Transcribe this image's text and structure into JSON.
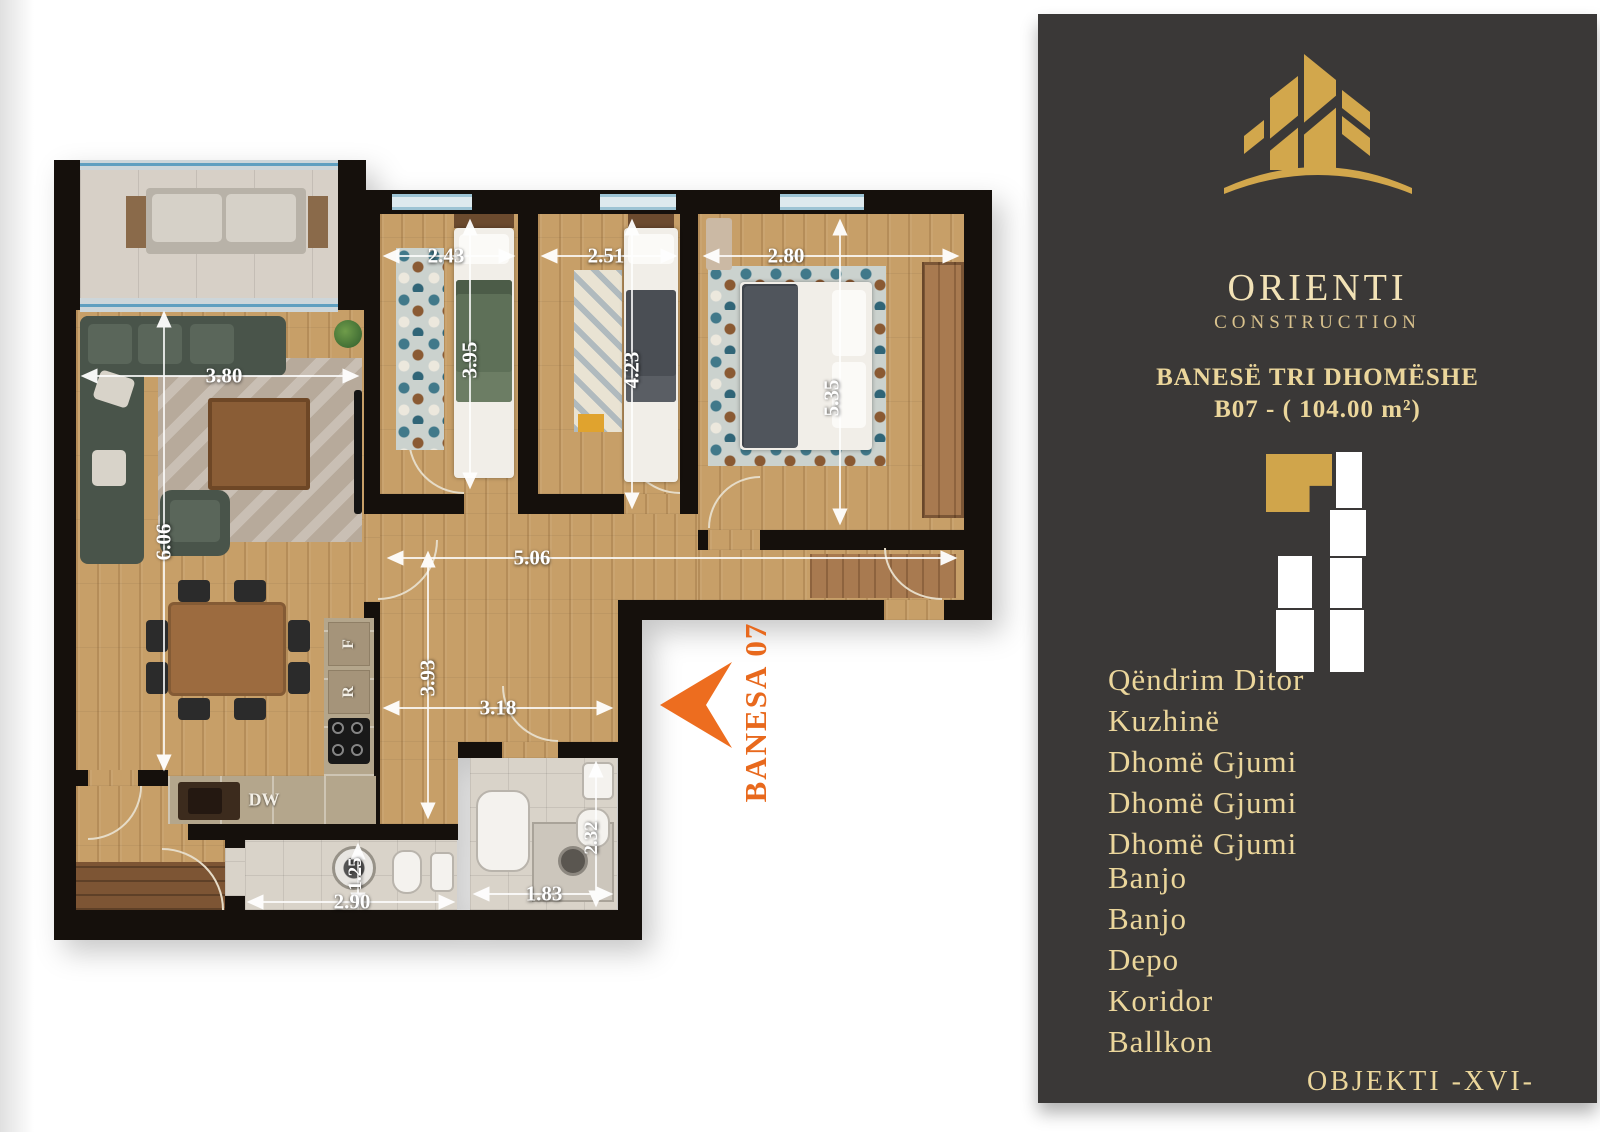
{
  "colors": {
    "panel_bg": "#3a3837",
    "gold": "#d0a54b",
    "cream": "#f2e2b6",
    "muted_gold": "#d9c28d",
    "list_gold": "#ebd69b",
    "orange": "#e8691d",
    "wall": "#15100c",
    "dim_white": "#ffffff"
  },
  "panel": {
    "brand_name": "ORIENTI",
    "brand_subtitle": "CONSTRUCTION",
    "apartment_type": "BANESË TRI DHOMËSHE",
    "apartment_code": "B07 - ( 104.00 m²)",
    "object_label": "OBJEKTI -XVI-",
    "rooms": [
      "Qëndrim Ditor",
      "Kuzhinë",
      "Dhomë Gjumi",
      "Dhomë Gjumi",
      "Dhomë Gjumi",
      "Banjo",
      "Banjo",
      "Depo",
      "Koridor",
      "Ballkon"
    ]
  },
  "plan": {
    "unit_label": "BANESA 07",
    "kitchen_labels": {
      "dishwasher": "DW",
      "refrigerator": "R",
      "freezer": "F"
    },
    "dimensions": {
      "bedroom1_width": "2.43",
      "bedroom1_depth": "3.95",
      "bedroom2_width": "2.51",
      "bedroom2_depth": "4.23",
      "bedroom3_width": "2.80",
      "bedroom3_depth": "5.35",
      "living_width": "3.80",
      "living_depth": "6.06",
      "corridor_length": "5.06",
      "hallway_depth": "3.93",
      "hallway_width": "3.18",
      "bathroom1_depth": "1.25",
      "bathroom1_width": "2.90",
      "bathroom2_width": "1.83",
      "bathroom2_depth": "2.32"
    }
  }
}
